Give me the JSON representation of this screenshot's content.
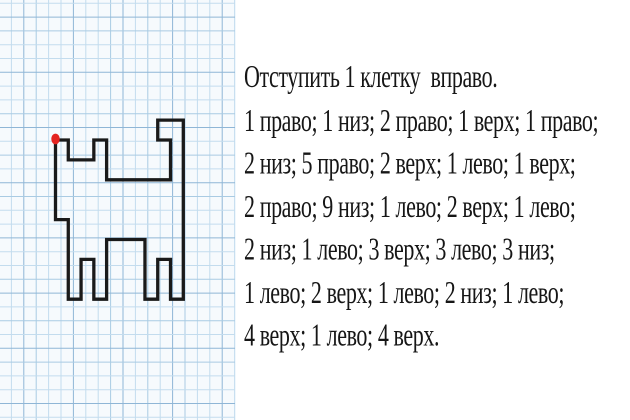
{
  "instructions": {
    "lines": [
      "Отступить 1 клетку  вправо.",
      "1 право; 1 низ; 2 право; 1 верх; 1 право;",
      "2 низ; 5 право; 2 верх; 1 лево; 1 верх;",
      "2 право; 9 низ; 1 лево; 2 верх; 1 лево;",
      "2 низ; 1 лево; 3 верх; 3 лево; 3 низ;",
      "1 лево; 2 верх; 1 лево; 2 низ; 1 лево;",
      "4 верх; 1 лево; 4 верх."
    ],
    "text_color": "#161616"
  },
  "figure": {
    "line_color": "#1a1a1a",
    "line_width_px": 3.3,
    "start_dot_color": "#e42420",
    "origin_px": [
      55.5,
      140
    ],
    "unit_x_px": 12.78,
    "unit_y_px": 19.9,
    "points_units": [
      [
        0,
        0
      ],
      [
        1,
        0
      ],
      [
        1,
        1
      ],
      [
        3,
        1
      ],
      [
        3,
        0
      ],
      [
        4,
        0
      ],
      [
        4,
        2
      ],
      [
        9,
        2
      ],
      [
        9,
        0
      ],
      [
        8,
        0
      ],
      [
        8,
        -1
      ],
      [
        10,
        -1
      ],
      [
        10,
        8
      ],
      [
        9,
        8
      ],
      [
        9,
        6
      ],
      [
        8,
        6
      ],
      [
        8,
        8
      ],
      [
        7,
        8
      ],
      [
        7,
        5
      ],
      [
        4,
        5
      ],
      [
        4,
        8
      ],
      [
        3,
        8
      ],
      [
        3,
        6
      ],
      [
        2,
        6
      ],
      [
        2,
        8
      ],
      [
        1,
        8
      ],
      [
        1,
        4
      ],
      [
        0,
        4
      ]
    ]
  },
  "grid": {
    "panel_width_px": 236,
    "panel_height_px": 420,
    "cell_w_px": 12.4,
    "cell_h_px": 13.8,
    "x0_px": -1,
    "y0_px": 3.3,
    "paper_color": "#f6fafd",
    "line_colors": [
      "#c3dcee",
      "#a9cbe3",
      "#8fb6d6"
    ]
  }
}
